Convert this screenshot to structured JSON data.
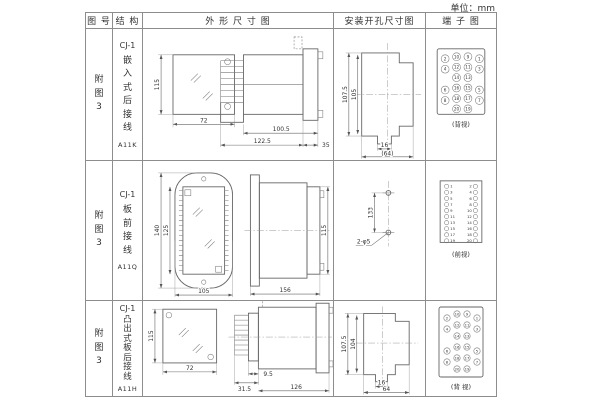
{
  "unit_label": "单位：mm",
  "header": {
    "fig_no": "图 号",
    "structure": "结 构",
    "outline": "外 形 尺 寸 图",
    "install": "安装开孔尺寸图",
    "terminal": "端 子 图"
  },
  "rows": [
    {
      "fig": "附图3",
      "structure": {
        "model": "CJ-1",
        "desc": "嵌入式后接线",
        "code": "A11K"
      },
      "outline": {
        "front_height": "115",
        "front_width": "72",
        "depth_body": "100.5",
        "depth_total": "122.5",
        "flange_depth": "35"
      },
      "install": {
        "outer_height": "107.5",
        "inner_height": "105",
        "tab_width": "16",
        "cutout_width": "(64)"
      },
      "terminal": {
        "view_label": "(背视)",
        "grid": [
          [
            "2",
            "10",
            "9",
            "1"
          ],
          [
            "4",
            "12",
            "11",
            "3"
          ],
          [
            "",
            "14",
            "13",
            ""
          ],
          [
            "6",
            "16",
            "15",
            "5"
          ],
          [
            "8",
            "18",
            "17",
            "7"
          ],
          [
            "",
            "20",
            "19",
            ""
          ]
        ]
      }
    },
    {
      "fig": "附图3",
      "structure": {
        "model": "CJ-1",
        "desc": "板前接线",
        "code": "A11Q"
      },
      "outline": {
        "front_outer_height": "140",
        "front_inner_height": "125",
        "front_width": "105",
        "depth": "156",
        "side_height": "115"
      },
      "install": {
        "hole_spacing": "133",
        "hole_label": "2-φ5"
      },
      "terminal": {
        "view_label": "(前视)",
        "left": [
          "1",
          "3",
          "5",
          "7",
          "9",
          "11",
          "13",
          "15",
          "17",
          "19"
        ],
        "right": [
          "2",
          "4",
          "6",
          "8",
          "10",
          "12",
          "14",
          "16",
          "18",
          "20"
        ]
      }
    },
    {
      "fig": "附图3",
      "structure": {
        "model": "CJ-1",
        "desc": "凸出式板后接线",
        "code": "A11H"
      },
      "outline": {
        "front_height": "115",
        "front_width": "72",
        "stem_depth": "31.5",
        "step_depth": "9.5",
        "body_depth": "126"
      },
      "install": {
        "outer_height": "107.5",
        "inner_height": "104",
        "tab_width": "16",
        "cutout_width": "64"
      },
      "terminal": {
        "view_label": "(背 视)",
        "grid": [
          [
            "2",
            "10",
            "9",
            "1"
          ],
          [
            "4",
            "12",
            "11",
            "3"
          ],
          [
            "",
            "14",
            "13",
            ""
          ],
          [
            "6",
            "16",
            "15",
            "5"
          ],
          [
            "8",
            "18",
            "17",
            "7"
          ],
          [
            "",
            "20",
            "19",
            ""
          ]
        ]
      }
    }
  ]
}
